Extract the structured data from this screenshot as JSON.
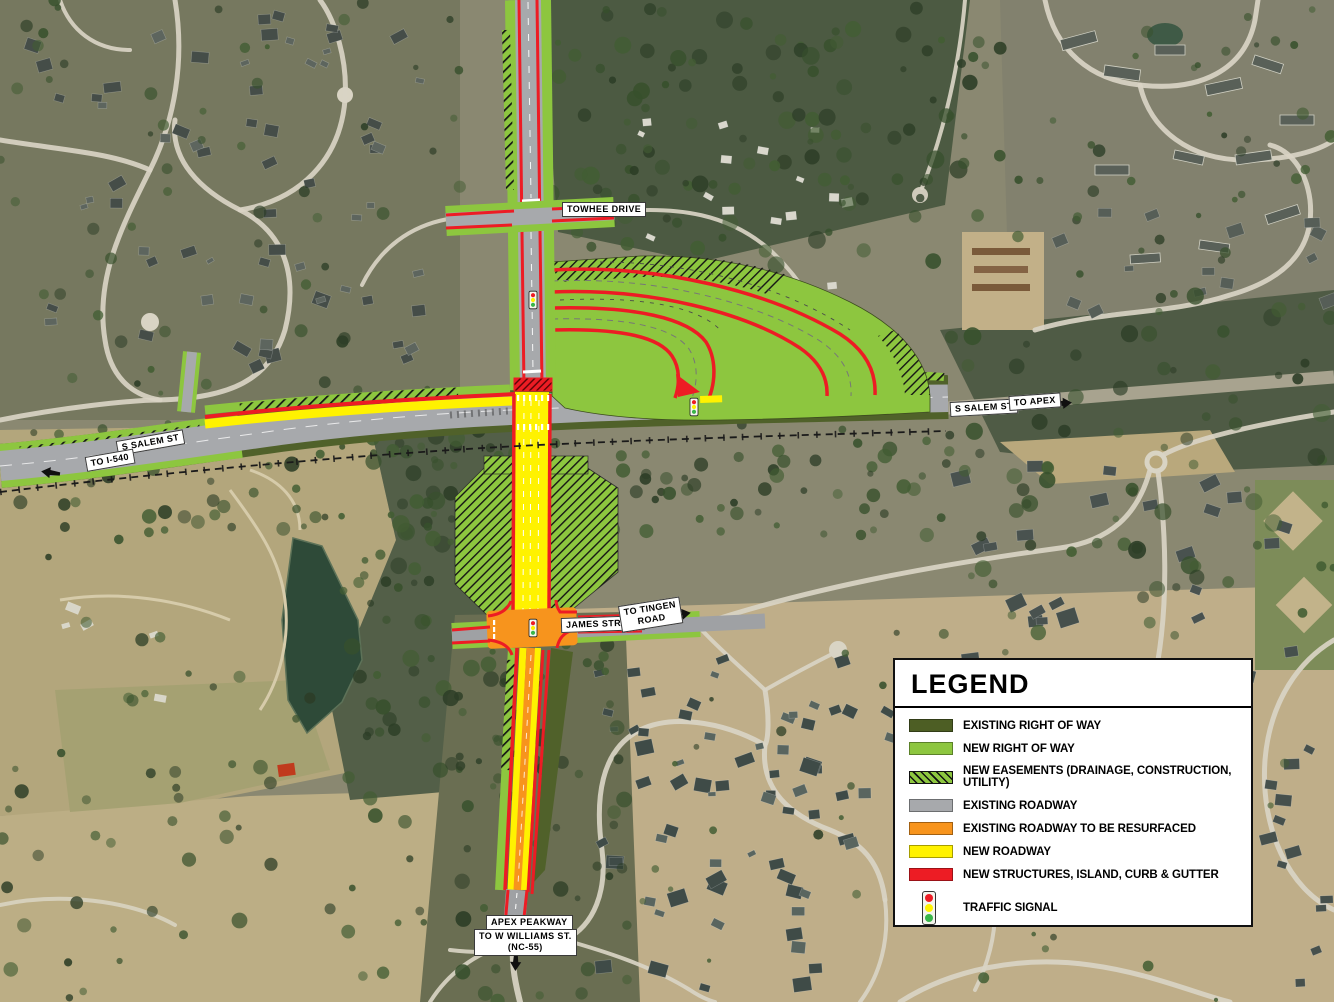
{
  "map_labels": {
    "towhee_drive": "TOWHEE DRIVE",
    "salem_st_east": "S SALEM ST",
    "to_apex": "TO APEX",
    "to_i540": "TO I-540",
    "salem_st_west": "S SALEM ST",
    "james_street": "JAMES STREET",
    "to_tingen_line1": "TO TINGEN",
    "to_tingen_line2": "ROAD",
    "apex_peakway": "APEX PEAKWAY",
    "to_w_williams": "TO W WILLIAMS ST.",
    "nc55": "(NC-55)"
  },
  "legend": {
    "title": "LEGEND",
    "items": [
      {
        "id": "existing-right-of-way",
        "label": "EXISTING RIGHT OF WAY",
        "type": "swatch",
        "color": "#4d5e24"
      },
      {
        "id": "new-right-of-way",
        "label": "NEW RIGHT OF WAY",
        "type": "swatch",
        "color": "#8dc63f"
      },
      {
        "id": "new-easements",
        "label": "NEW EASEMENTS (DRAINAGE, CONSTRUCTION, UTILITY)",
        "type": "hatch",
        "color": "#8dc63f"
      },
      {
        "id": "existing-roadway",
        "label": "EXISTING ROADWAY",
        "type": "swatch",
        "color": "#a7a9ac"
      },
      {
        "id": "existing-roadway-resurfaced",
        "label": "EXISTING ROADWAY TO BE RESURFACED",
        "type": "swatch",
        "color": "#f7941d"
      },
      {
        "id": "new-roadway",
        "label": "NEW ROADWAY",
        "type": "swatch",
        "color": "#fff200"
      },
      {
        "id": "new-structures",
        "label": "NEW STRUCTURES, ISLAND, CURB & GUTTER",
        "type": "swatch",
        "color": "#ed1c24"
      },
      {
        "id": "traffic-signal",
        "label": "TRAFFIC SIGNAL",
        "type": "signal"
      }
    ],
    "signal_colors": {
      "red": "#ed1c24",
      "yellow": "#fff200",
      "green": "#39b54a"
    }
  }
}
